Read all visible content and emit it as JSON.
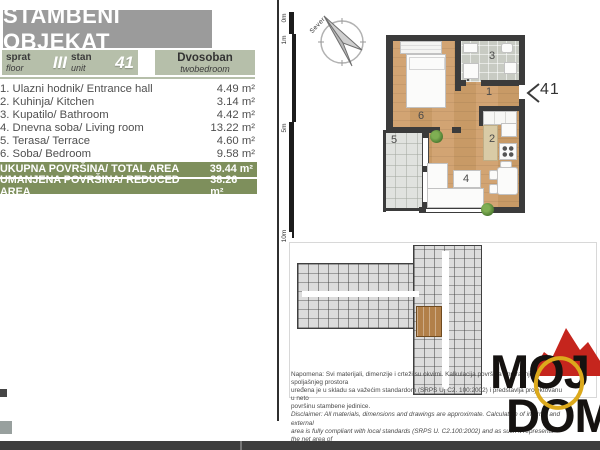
{
  "header": {
    "title": "STAMBENI OBJEKAT"
  },
  "unit_info": {
    "floor": {
      "label_sr": "sprat",
      "label_en": "floor",
      "value": "III"
    },
    "unit": {
      "label_sr": "stan",
      "label_en": "unit",
      "value": "41"
    },
    "type": {
      "label_sr": "Dvosoban",
      "label_en": "twobedroom"
    }
  },
  "rooms": [
    {
      "name": "1. Ulazni hodnik/ Entrance hall",
      "area": "4.49 m²"
    },
    {
      "name": "2. Kuhinja/ Kitchen",
      "area": "3.14 m²"
    },
    {
      "name": "3. Kupatilo/ Bathroom",
      "area": "4.42 m²"
    },
    {
      "name": "4. Dnevna soba/ Living room",
      "area": "13.22 m²"
    },
    {
      "name": "5. Terasa/ Terrace",
      "area": "4.60 m²"
    },
    {
      "name": "6. Soba/ Bedroom",
      "area": "9.58 m²"
    }
  ],
  "totals": [
    {
      "label": "UKUPNA POVRŠINA/ TOTAL AREA",
      "value": "39.44 m²"
    },
    {
      "label": "UMANJENA POVRŠINA/ REDUCED AREA",
      "value": "38.26 m²"
    }
  ],
  "plan": {
    "compass_label": "Sever",
    "scale_marks": [
      "0m",
      "1m",
      "5m",
      "10m"
    ],
    "entrance_marker": "41",
    "room_labels": {
      "entrance_hall": "1",
      "kitchen": "2",
      "bathroom": "3",
      "living_room": "4",
      "terrace": "5",
      "bedroom": "6"
    }
  },
  "disclaimer": {
    "lines": [
      "Napomena: Svi materijali, dimenzije i crteži su okvirni. Kalkulacija površina unutrašnjeg i spoljašnjeg prostora",
      "uređena je u skladu sa važećim standardom (SRPS U. C2. 100:2002) i predstavlja projektovanu u neto",
      "površinu stambene jedinice.",
      "Disclaimer: All materials, dimensions and drawings are approximate. Calculation of internal and external",
      "area is fully compliant with local standards (SRPS U. C2.100:2002) and as such it represents the net area of",
      "the unit."
    ]
  },
  "logo": {
    "top": "MOJ",
    "bottom": "DOM"
  },
  "colors": {
    "title_gray": "#9b9b9b",
    "cell_sage": "#b6bfaa",
    "accent_olive": "#7e8f5c",
    "wall_dark": "#3b3b3b",
    "highlight_brown": "#b28049",
    "logo_red": "#c5251d",
    "logo_yellow": "#dca91c"
  }
}
